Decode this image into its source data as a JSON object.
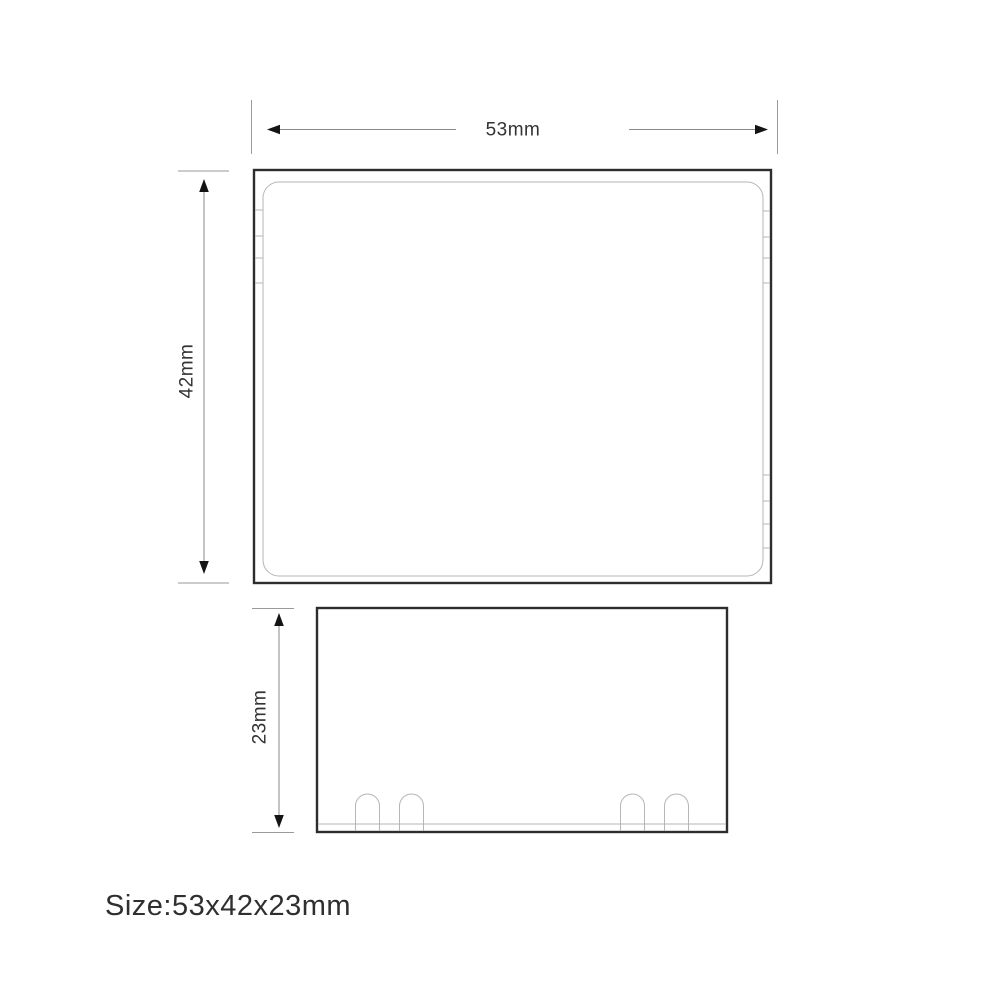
{
  "diagram": {
    "caption": "Size:53x42x23mm",
    "views": {
      "top": {
        "width_label": "53mm",
        "height_label": "42mm"
      },
      "front": {
        "height_label": "23mm"
      }
    },
    "icons": {
      "width_arrows": "arrowhead-left-icon / arrowhead-right-icon",
      "height_arrows": "arrowhead-up-icon / arrowhead-down-icon"
    },
    "colors": {
      "background": "#ffffff",
      "outline": "#2d2d2d",
      "detail_line": "#b6b6b6",
      "dimension_line": "#8a8a8a",
      "arrowhead": "#141414",
      "label_text": "#333333"
    }
  }
}
